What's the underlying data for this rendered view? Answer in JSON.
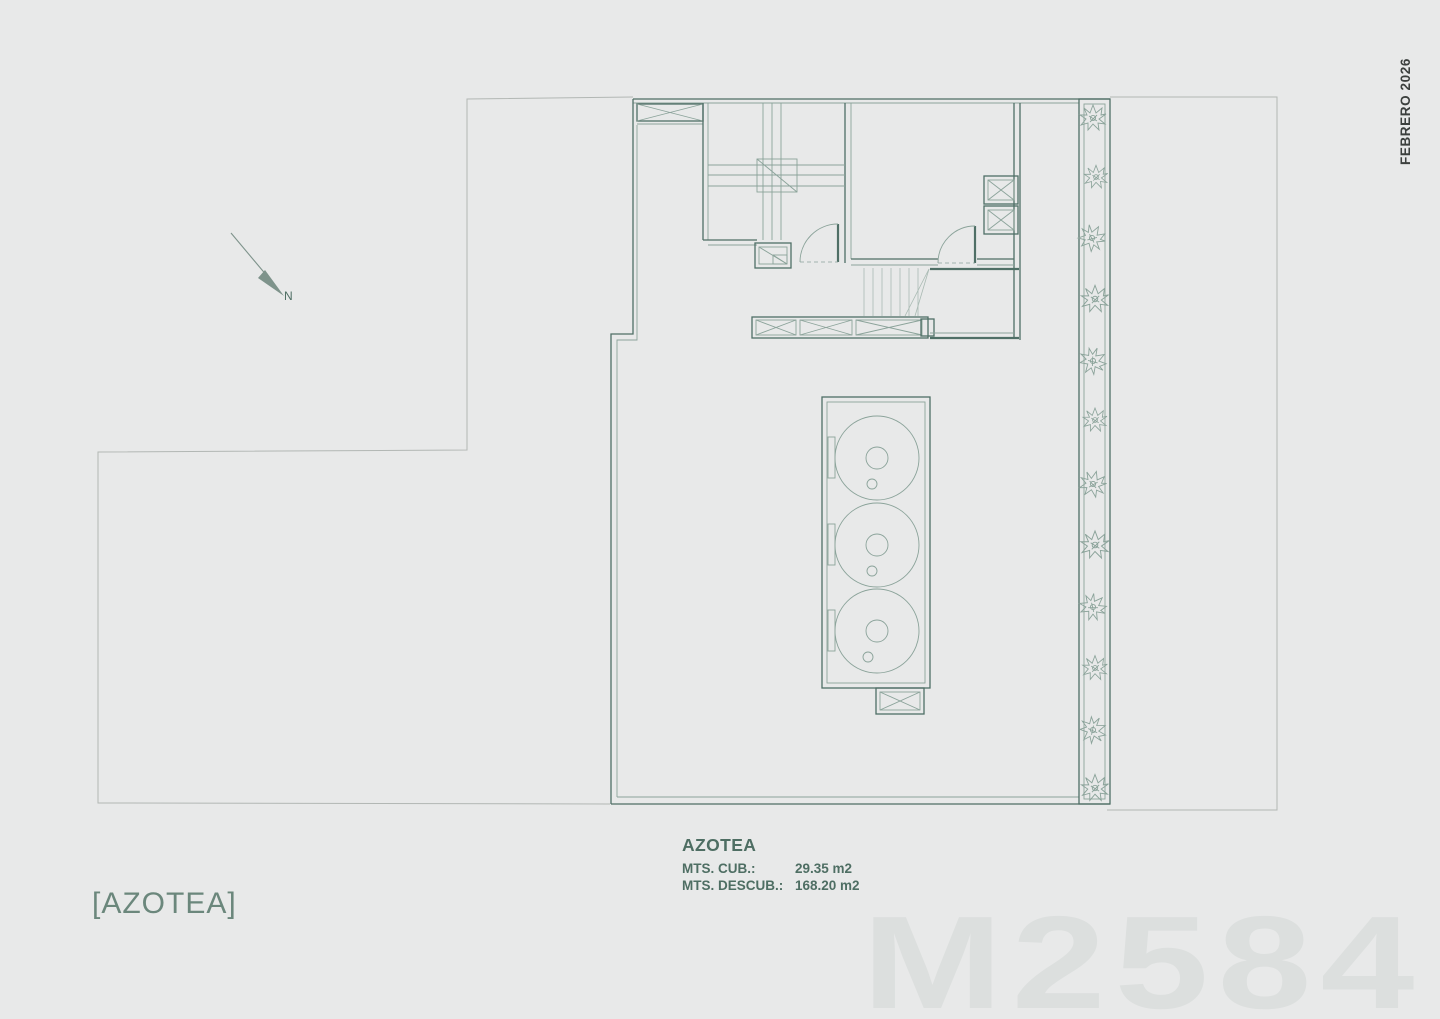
{
  "header": {
    "date_label": "FEBRERO 2026"
  },
  "north": {
    "label": "N"
  },
  "info": {
    "title": "AZOTEA",
    "rows": [
      {
        "label": "MTS. CUB.:",
        "value": "29.35 m2"
      },
      {
        "label": "MTS. DESCUB.:",
        "value": "168.20 m2"
      }
    ]
  },
  "footer": {
    "plan_label": "[AZOTEA]",
    "watermark": "M2584"
  },
  "colors": {
    "background": "#e8e9e9",
    "wall": "#4f6f66",
    "detail": "#8ba39a",
    "light": "#a9bab3",
    "boundary": "#b2b7b4",
    "text": "#4e6e63",
    "label": "#6b877c",
    "date": "#3c403e",
    "watermark": "#dcdfde",
    "north": "#7e938b"
  }
}
